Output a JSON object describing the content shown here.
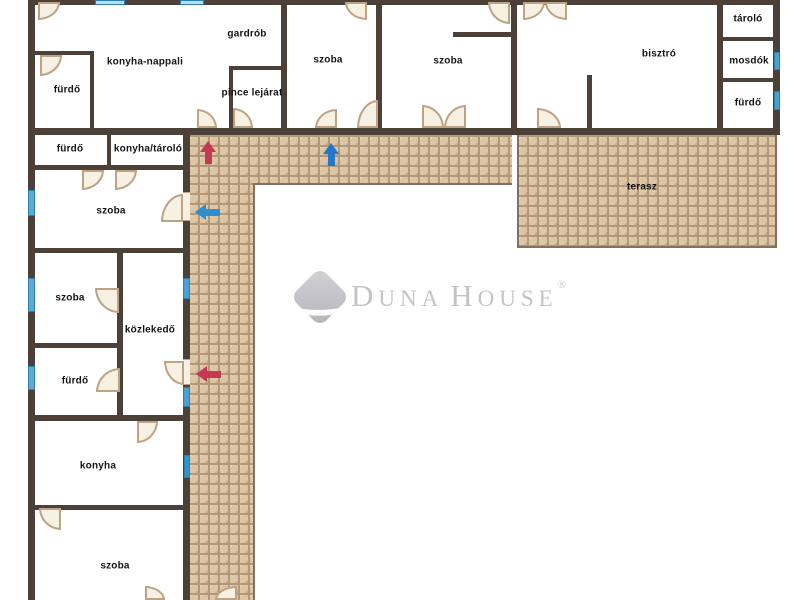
{
  "watermark": {
    "d1": "D",
    "r1": "UNA",
    "d2": "H",
    "r2": "OUSE",
    "reg": "®"
  },
  "floorplan": {
    "wall_color": "#4b4138",
    "paving_color": "#dcc6a5",
    "rooms": [
      {
        "id": "furdo-top-left",
        "label": "fürdő",
        "cx": 67,
        "cy": 90
      },
      {
        "id": "konyha-nappali",
        "label": "konyha-nappali",
        "cx": 145,
        "cy": 62
      },
      {
        "id": "gardrob",
        "label": "gardrób",
        "cx": 247,
        "cy": 34
      },
      {
        "id": "pince-lejarat",
        "label": "pince lejárat",
        "cx": 252,
        "cy": 93
      },
      {
        "id": "szoba-1",
        "label": "szoba",
        "cx": 328,
        "cy": 60
      },
      {
        "id": "szoba-2",
        "label": "szoba",
        "cx": 448,
        "cy": 61
      },
      {
        "id": "bisztro",
        "label": "bisztró",
        "cx": 659,
        "cy": 54
      },
      {
        "id": "tarolo",
        "label": "tároló",
        "cx": 748,
        "cy": 19
      },
      {
        "id": "mosdok",
        "label": "mosdók",
        "cx": 749,
        "cy": 61
      },
      {
        "id": "furdo-top-right",
        "label": "fürdő",
        "cx": 748,
        "cy": 103
      },
      {
        "id": "furdo-mid",
        "label": "fürdő",
        "cx": 70,
        "cy": 149
      },
      {
        "id": "konyha-tarolo",
        "label": "konyha/tároló",
        "cx": 148,
        "cy": 149
      },
      {
        "id": "szoba-3",
        "label": "szoba",
        "cx": 111,
        "cy": 211
      },
      {
        "id": "terasz",
        "label": "terasz",
        "cx": 642,
        "cy": 187
      },
      {
        "id": "szoba-4",
        "label": "szoba",
        "cx": 70,
        "cy": 298
      },
      {
        "id": "kozlekedo",
        "label": "közlekedő",
        "cx": 150,
        "cy": 330
      },
      {
        "id": "furdo-left",
        "label": "fürdő",
        "cx": 75,
        "cy": 381
      },
      {
        "id": "konyha",
        "label": "konyha",
        "cx": 98,
        "cy": 466
      },
      {
        "id": "szoba-5",
        "label": "szoba",
        "cx": 115,
        "cy": 566
      }
    ],
    "hatch": [
      {
        "id": "walkway-horizontal",
        "x": 190,
        "y": 135,
        "w": 322,
        "h": 50,
        "b": [
          "bottom"
        ]
      },
      {
        "id": "walkway-vertical",
        "x": 190,
        "y": 183,
        "w": 65,
        "h": 417,
        "b": [
          "right"
        ]
      },
      {
        "id": "terasz",
        "x": 517,
        "y": 135,
        "w": 260,
        "h": 113,
        "b": [
          "left",
          "right",
          "bottom"
        ]
      }
    ],
    "walls": [
      {
        "x": 28,
        "y": 0,
        "w": 752,
        "h": 5
      },
      {
        "x": 28,
        "y": 0,
        "w": 7,
        "h": 600
      },
      {
        "x": 773,
        "y": 0,
        "w": 7,
        "h": 135
      },
      {
        "x": 28,
        "y": 128,
        "w": 752,
        "h": 7
      },
      {
        "x": 28,
        "y": 51,
        "w": 66,
        "h": 4
      },
      {
        "x": 90,
        "y": 51,
        "w": 4,
        "h": 77
      },
      {
        "x": 229,
        "y": 66,
        "w": 54,
        "h": 4
      },
      {
        "x": 229,
        "y": 66,
        "w": 4,
        "h": 62
      },
      {
        "x": 281,
        "y": 0,
        "w": 6,
        "h": 128
      },
      {
        "x": 376,
        "y": 0,
        "w": 6,
        "h": 128
      },
      {
        "x": 511,
        "y": 0,
        "w": 6,
        "h": 128
      },
      {
        "x": 453,
        "y": 32,
        "w": 60,
        "h": 5
      },
      {
        "x": 587,
        "y": 75,
        "w": 5,
        "h": 53
      },
      {
        "x": 717,
        "y": 0,
        "w": 6,
        "h": 128
      },
      {
        "x": 723,
        "y": 37,
        "w": 51,
        "h": 4
      },
      {
        "x": 723,
        "y": 78,
        "w": 51,
        "h": 4
      },
      {
        "x": 107,
        "y": 135,
        "w": 4,
        "h": 32
      },
      {
        "x": 28,
        "y": 165,
        "w": 162,
        "h": 5
      },
      {
        "x": 183,
        "y": 128,
        "w": 7,
        "h": 472
      },
      {
        "x": 28,
        "y": 248,
        "w": 162,
        "h": 5
      },
      {
        "x": 117,
        "y": 252,
        "w": 6,
        "h": 166
      },
      {
        "x": 28,
        "y": 343,
        "w": 95,
        "h": 5
      },
      {
        "x": 28,
        "y": 415,
        "w": 162,
        "h": 6
      },
      {
        "x": 28,
        "y": 505,
        "w": 162,
        "h": 5
      }
    ],
    "windows": [
      {
        "x": 95,
        "y": 0,
        "w": 30,
        "h": 5,
        "color": "#b5dcef"
      },
      {
        "x": 180,
        "y": 0,
        "w": 24,
        "h": 5,
        "color": "#b5dcef"
      },
      {
        "x": 774,
        "y": 52,
        "w": 6,
        "h": 18,
        "color": "#4aa0d2"
      },
      {
        "x": 774,
        "y": 91,
        "w": 6,
        "h": 19,
        "color": "#4aa0d2"
      },
      {
        "x": 28,
        "y": 190,
        "w": 7,
        "h": 26,
        "color": "#5fa8d8"
      },
      {
        "x": 28,
        "y": 278,
        "w": 7,
        "h": 34,
        "color": "#5fa8d8"
      },
      {
        "x": 28,
        "y": 366,
        "w": 7,
        "h": 24,
        "color": "#5fa8d8"
      },
      {
        "x": 183,
        "y": 278,
        "w": 7,
        "h": 21,
        "color": "#4aa0d2"
      },
      {
        "x": 183,
        "y": 387,
        "w": 7,
        "h": 20,
        "color": "#4aa0d2"
      },
      {
        "x": 184,
        "y": 455,
        "w": 6,
        "h": 23,
        "color": "#2e96ce"
      }
    ],
    "openings": [
      {
        "x": 183,
        "y": 192,
        "w": 7,
        "h": 29
      },
      {
        "x": 183,
        "y": 359,
        "w": 7,
        "h": 26
      }
    ],
    "doors": [
      {
        "x": 38,
        "y": 2,
        "w": 22,
        "h": 18,
        "c": "br"
      },
      {
        "x": 40,
        "y": 55,
        "w": 22,
        "h": 21,
        "c": "br"
      },
      {
        "x": 197,
        "y": 109,
        "w": 20,
        "h": 19,
        "c": "tr"
      },
      {
        "x": 233,
        "y": 108,
        "w": 20,
        "h": 20,
        "c": "tr"
      },
      {
        "x": 345,
        "y": 2,
        "w": 22,
        "h": 18,
        "c": "bl"
      },
      {
        "x": 315,
        "y": 109,
        "w": 22,
        "h": 19,
        "c": "tl"
      },
      {
        "x": 357,
        "y": 100,
        "w": 21,
        "h": 28,
        "c": "tl"
      },
      {
        "x": 422,
        "y": 105,
        "w": 22,
        "h": 23,
        "c": "tr"
      },
      {
        "x": 444,
        "y": 105,
        "w": 22,
        "h": 23,
        "c": "tl"
      },
      {
        "x": 488,
        "y": 2,
        "w": 22,
        "h": 22,
        "c": "bl"
      },
      {
        "x": 523,
        "y": 2,
        "w": 22,
        "h": 18,
        "c": "br"
      },
      {
        "x": 545,
        "y": 2,
        "w": 22,
        "h": 18,
        "c": "bl"
      },
      {
        "x": 537,
        "y": 108,
        "w": 24,
        "h": 20,
        "c": "tr"
      },
      {
        "x": 82,
        "y": 170,
        "w": 22,
        "h": 20,
        "c": "br"
      },
      {
        "x": 115,
        "y": 170,
        "w": 22,
        "h": 20,
        "c": "br"
      },
      {
        "x": 161,
        "y": 194,
        "w": 22,
        "h": 28,
        "c": "tl"
      },
      {
        "x": 95,
        "y": 288,
        "w": 24,
        "h": 25,
        "c": "bl"
      },
      {
        "x": 96,
        "y": 368,
        "w": 24,
        "h": 24,
        "c": "tl"
      },
      {
        "x": 164,
        "y": 361,
        "w": 20,
        "h": 24,
        "c": "bl"
      },
      {
        "x": 137,
        "y": 421,
        "w": 21,
        "h": 22,
        "c": "br"
      },
      {
        "x": 39,
        "y": 508,
        "w": 22,
        "h": 22,
        "c": "bl"
      },
      {
        "x": 145,
        "y": 586,
        "w": 20,
        "h": 14,
        "c": "tr"
      },
      {
        "x": 215,
        "y": 586,
        "w": 22,
        "h": 14,
        "c": "tl"
      }
    ],
    "arrows": [
      {
        "id": "red-up",
        "dir": "up",
        "color": "#c53a52",
        "x": 200,
        "y": 141
      },
      {
        "id": "blue-up",
        "dir": "up",
        "color": "#2577c9",
        "x": 323,
        "y": 143
      },
      {
        "id": "blue-left",
        "dir": "left",
        "color": "#2e8fd0",
        "x": 195,
        "y": 204
      },
      {
        "id": "red-left",
        "dir": "left",
        "color": "#c53a52",
        "x": 196,
        "y": 366
      }
    ]
  }
}
